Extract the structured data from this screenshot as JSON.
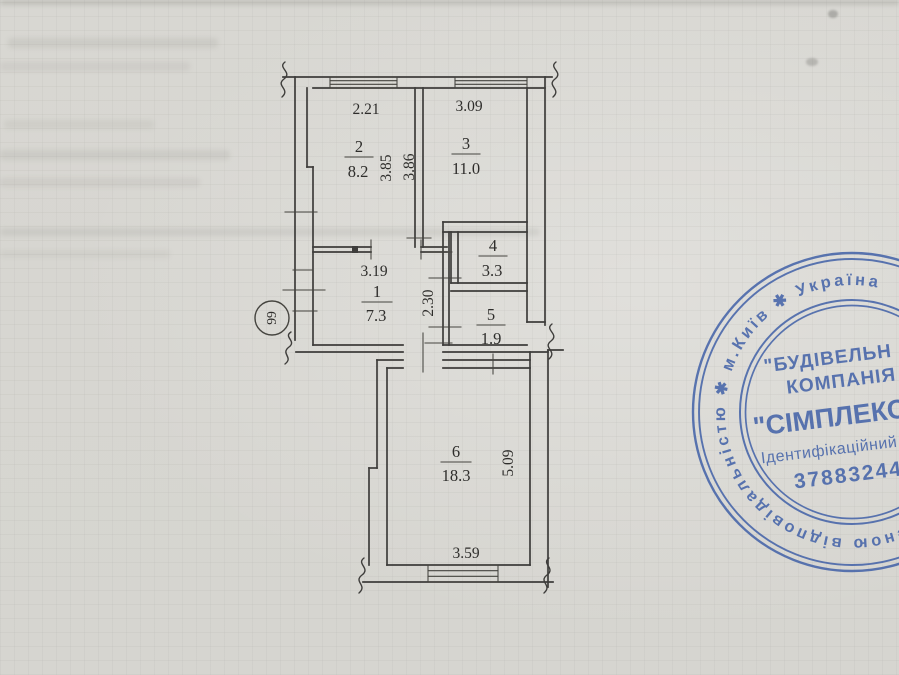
{
  "paper": {
    "background": "#d8d7d2",
    "grid_line": "#8c8c86",
    "ink": "#3e3d3b",
    "label_ink": "#2e2d2b"
  },
  "plan": {
    "rooms": [
      {
        "number": "1",
        "area": "7.3"
      },
      {
        "number": "2",
        "area": "8.2"
      },
      {
        "number": "3",
        "area": "11.0"
      },
      {
        "number": "4",
        "area": "3.3"
      },
      {
        "number": "5",
        "area": "1.9"
      },
      {
        "number": "6",
        "area": "18.3"
      }
    ],
    "dimensions": {
      "room2_width": "2.21",
      "room3_width": "3.09",
      "room2_depth": "3.85",
      "room3_depth": "3.86",
      "room1_width": "3.19",
      "room1_depth": "2.30",
      "room6_width": "3.59",
      "room6_depth": "5.09"
    },
    "sheet_mark": "99"
  },
  "stamp": {
    "color": "#3b5ca6",
    "ring_text": "женою відповідальністю ✱ м.Київ ✱ Україна",
    "company_line1": "\"БУДІВЕЛЬН",
    "company_line2": "КОМПАНІЯ",
    "company_line3": "\"СІМПЛЕКС-С",
    "id_label": "Ідентифікаційний",
    "id_number": "37883244"
  }
}
